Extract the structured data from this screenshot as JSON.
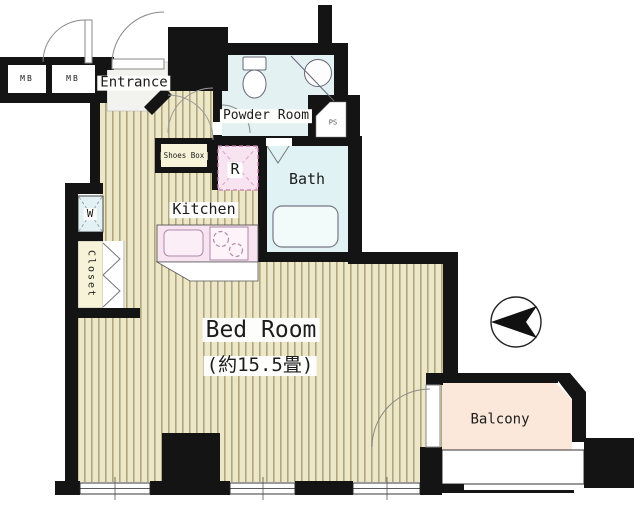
{
  "plan": {
    "title": "apartment-floor-plan",
    "labels": {
      "mb1": "MB",
      "mb2": "MB",
      "entrance": "Entrance",
      "powder_room": "Powder Room",
      "shoes_box": "Shoes Box",
      "refrigerator_mark": "R",
      "bath": "Bath",
      "kitchen": "Kitchen",
      "washer_mark": "W",
      "closet": "Closet",
      "bedroom_name": "Bed Room",
      "bedroom_size": "(約15.5畳)",
      "balcony": "Balcony",
      "pipe_space_mark": "PS"
    },
    "colors": {
      "wall": "#141414",
      "floor_base": "#ede7c9",
      "floor_stripe": "#b1a77b",
      "powder_room": "#e3f1f3",
      "bath": "#e0f2f3",
      "kitchen_counter": "#f8e4f1",
      "refrigerator_box": "#f8e4f1",
      "closet": "#f7f3d8",
      "shoes_box": "#f7f3d8",
      "washer_box": "#e4f1f4",
      "entrance_floor": "#f2f2ef",
      "balcony_floor": "#fbe8da"
    }
  }
}
